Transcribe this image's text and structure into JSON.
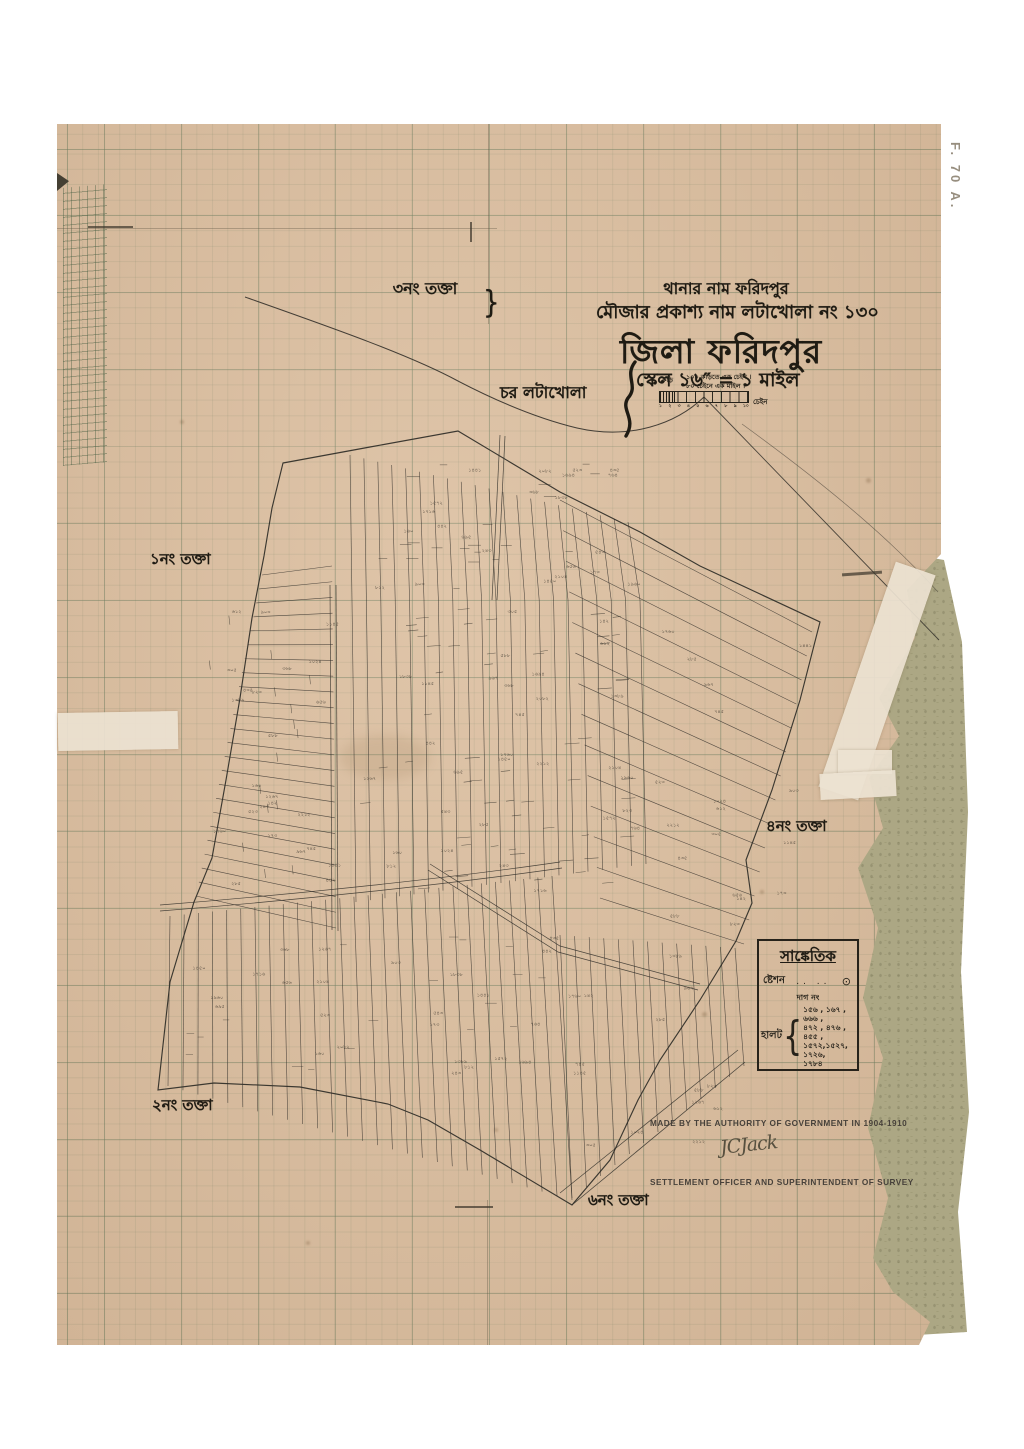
{
  "page": {
    "sheet_label": "F. 70 A."
  },
  "header": {
    "thana_line": "থানার নাম ফরিদপুর",
    "mouza_line": "মৌজার প্রকাশ্য নাম লটাখোলা নং ১৩০",
    "district_title": "জিলা ফরিদপুর",
    "scale_line": "স্কেল ১৬″ = ১ মাইল"
  },
  "scale_bar": {
    "note_line1": "১০০ কড়িতে এক চেইন  ।",
    "note_line2": "৮০ চেইনে এক মাইল  ।",
    "left_unit_label": "কড়ি",
    "right_unit_label": "চেইন",
    "tick_labels": [
      "১",
      "২",
      "৩",
      "৪",
      "৫",
      "৬",
      "৭",
      "৮",
      "৯",
      "১০"
    ]
  },
  "takta3": {
    "title": "৩নং তক্তা",
    "dag_line1": "দাগ নং ১৪১–২৫৩,২৮৫–৯০৫,১৪২১–১৪৫৩,১৪৫৮–১৪৬১,১৭১৮–",
    "dag_line2": "–১৭৪৫,১৭৬০–১৭৮৪,২০৬৭+২১৮৮–২২১২,২২৬৭–২২৭০",
    "bracket": "}",
    "bracket_note": "এই তক্তার ভুক্ত"
  },
  "region_labels": {
    "char": "চর লটাখোলা",
    "takta1": "১নং তক্তা",
    "takta2": "২নং তক্তা",
    "takta4": "৪নং তক্তা",
    "takta6": "৬নং তক্তা"
  },
  "legend": {
    "title": "সাঙ্কেতিক",
    "station_label": "ষ্টেশন",
    "station_dots": "..    ..",
    "station_symbol": "⊙",
    "dag_no_label": "দাগ নং",
    "halot_label": "হালট",
    "halot_brace": "{",
    "halot_numbers": [
      "১৫৬ , ১৬৭ , ৬৬৬ ,",
      "৪৭২ , ৪৭৬ , ৪৫৫ ,",
      "১৫৭২,১৫২৭, ১৭২৬,",
      "১৭৮৪"
    ]
  },
  "footer": {
    "authority_line": "MADE BY THE AUTHORITY OF GOVERNMENT IN 1904-1910",
    "officer_line": "SETTLEMENT OFFICER AND SUPERINTENDENT OF SURVEY",
    "signature": "JCJack"
  },
  "map": {
    "plot_numbers": [
      "২৪৩",
      "৩৬৮",
      "১৬০",
      "৪৪২",
      "১৭৩",
      "৬৫৬",
      "৪৩৫",
      "৫২৩",
      "১৪৪১",
      "৯০৩",
      "২৮৫",
      "১৭৬০",
      "২২১২",
      "১৪২",
      "৩০৫",
      "৫৮৮",
      "৬১২",
      "৭৪৫",
      "৮২৩",
      "৯৬৭",
      "১০২৪",
      "১১৪৫",
      "১২৬৭",
      "১৩৮৯",
      "১৪৫০",
      "১৫৭২",
      "১৬৯৪",
      "১৭১৬",
      "১৮৩৮",
      "১৯৬০",
      "২০৮২",
      "২১০৪",
      "৬৯৫",
      "৭৬৪",
      "৮১২",
      "৫৪৩"
    ]
  },
  "colors": {
    "paper": "#d9bc9e",
    "grid": "#60745a",
    "ink": "#33302a",
    "backing": "#aca784",
    "tape": "#ebe2d1"
  }
}
